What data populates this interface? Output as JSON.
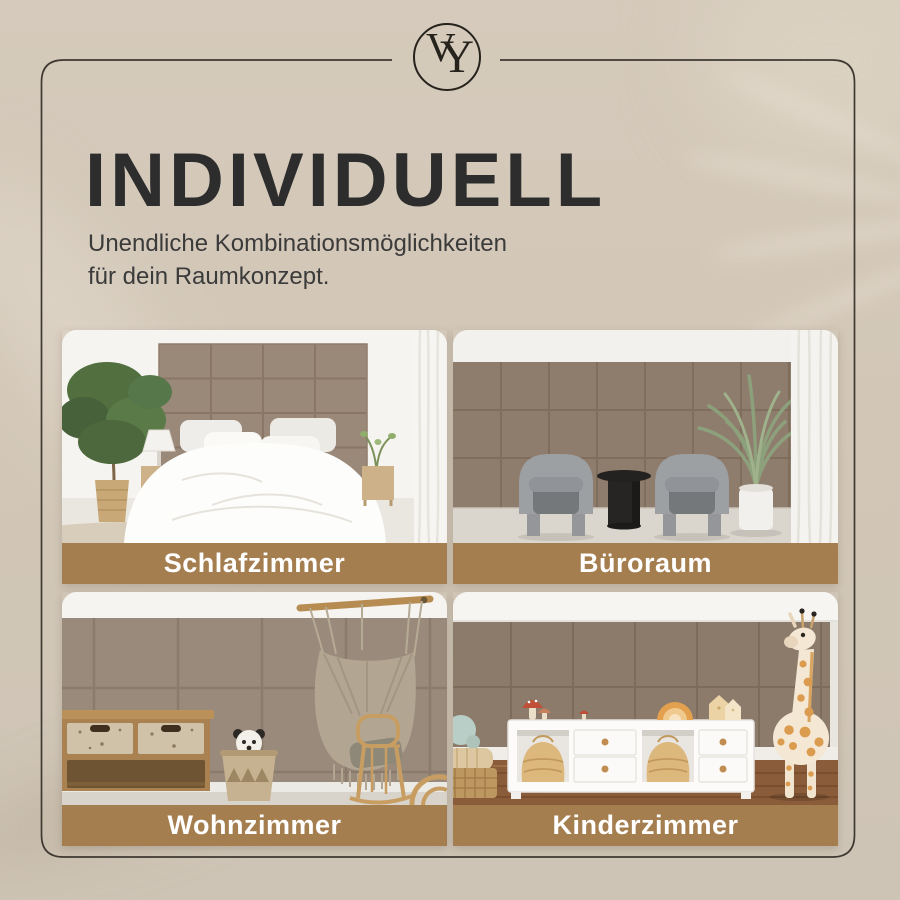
{
  "brand": {
    "monogram_left": "V",
    "monogram_right": "Y"
  },
  "header": {
    "title": "INDIVIDUELL",
    "subtitle_line1": "Unendliche Kombinationsmöglichkeiten",
    "subtitle_line2": "für dein Raumkonzept."
  },
  "tiles": [
    {
      "label": "Schlafzimmer",
      "scene": "bedroom"
    },
    {
      "label": "Büroraum",
      "scene": "office"
    },
    {
      "label": "Wohnzimmer",
      "scene": "living-room"
    },
    {
      "label": "Kinderzimmer",
      "scene": "kids-room"
    }
  ],
  "colors": {
    "background": "#d2c7b7",
    "frame": "#3f3932",
    "title_text": "#2d2d2d",
    "subtitle_text": "#3b3b3b",
    "banner": "#a57e4f",
    "banner_text": "#ffffff",
    "panel": "#9a8878"
  }
}
